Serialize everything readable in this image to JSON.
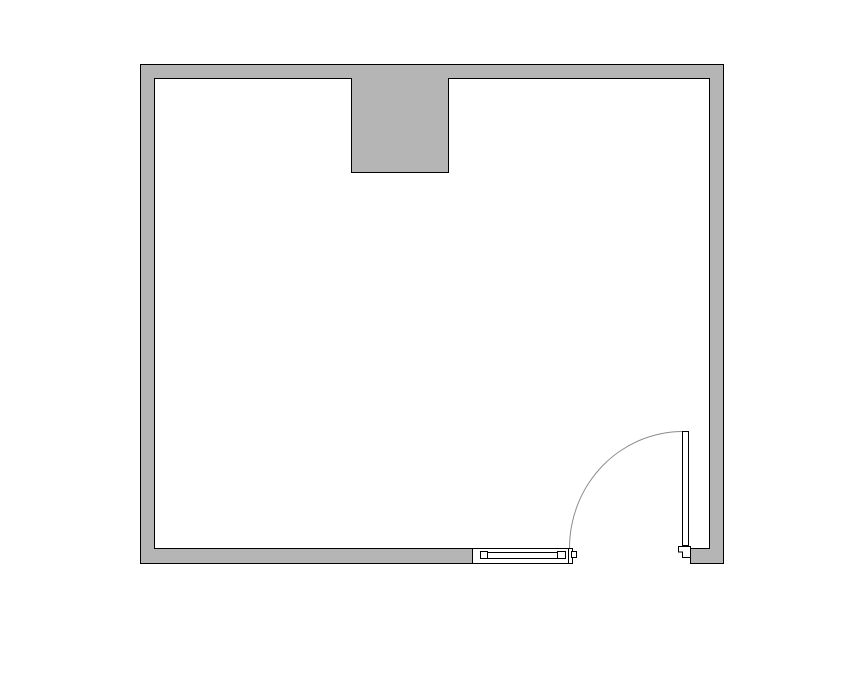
{
  "colors": {
    "background": "#ffffff",
    "wall_fill": "#b5b5b5",
    "wall_outline": "#000000",
    "fixture_fill": "#ffffff",
    "door_swing_arc": "#8c8c8c"
  },
  "plan": {
    "features": [
      "exterior-wall-ring",
      "wall-column",
      "window-with-end-posts",
      "door-opening",
      "door-leaf",
      "door-swing-arc",
      "door-stop-block"
    ]
  }
}
